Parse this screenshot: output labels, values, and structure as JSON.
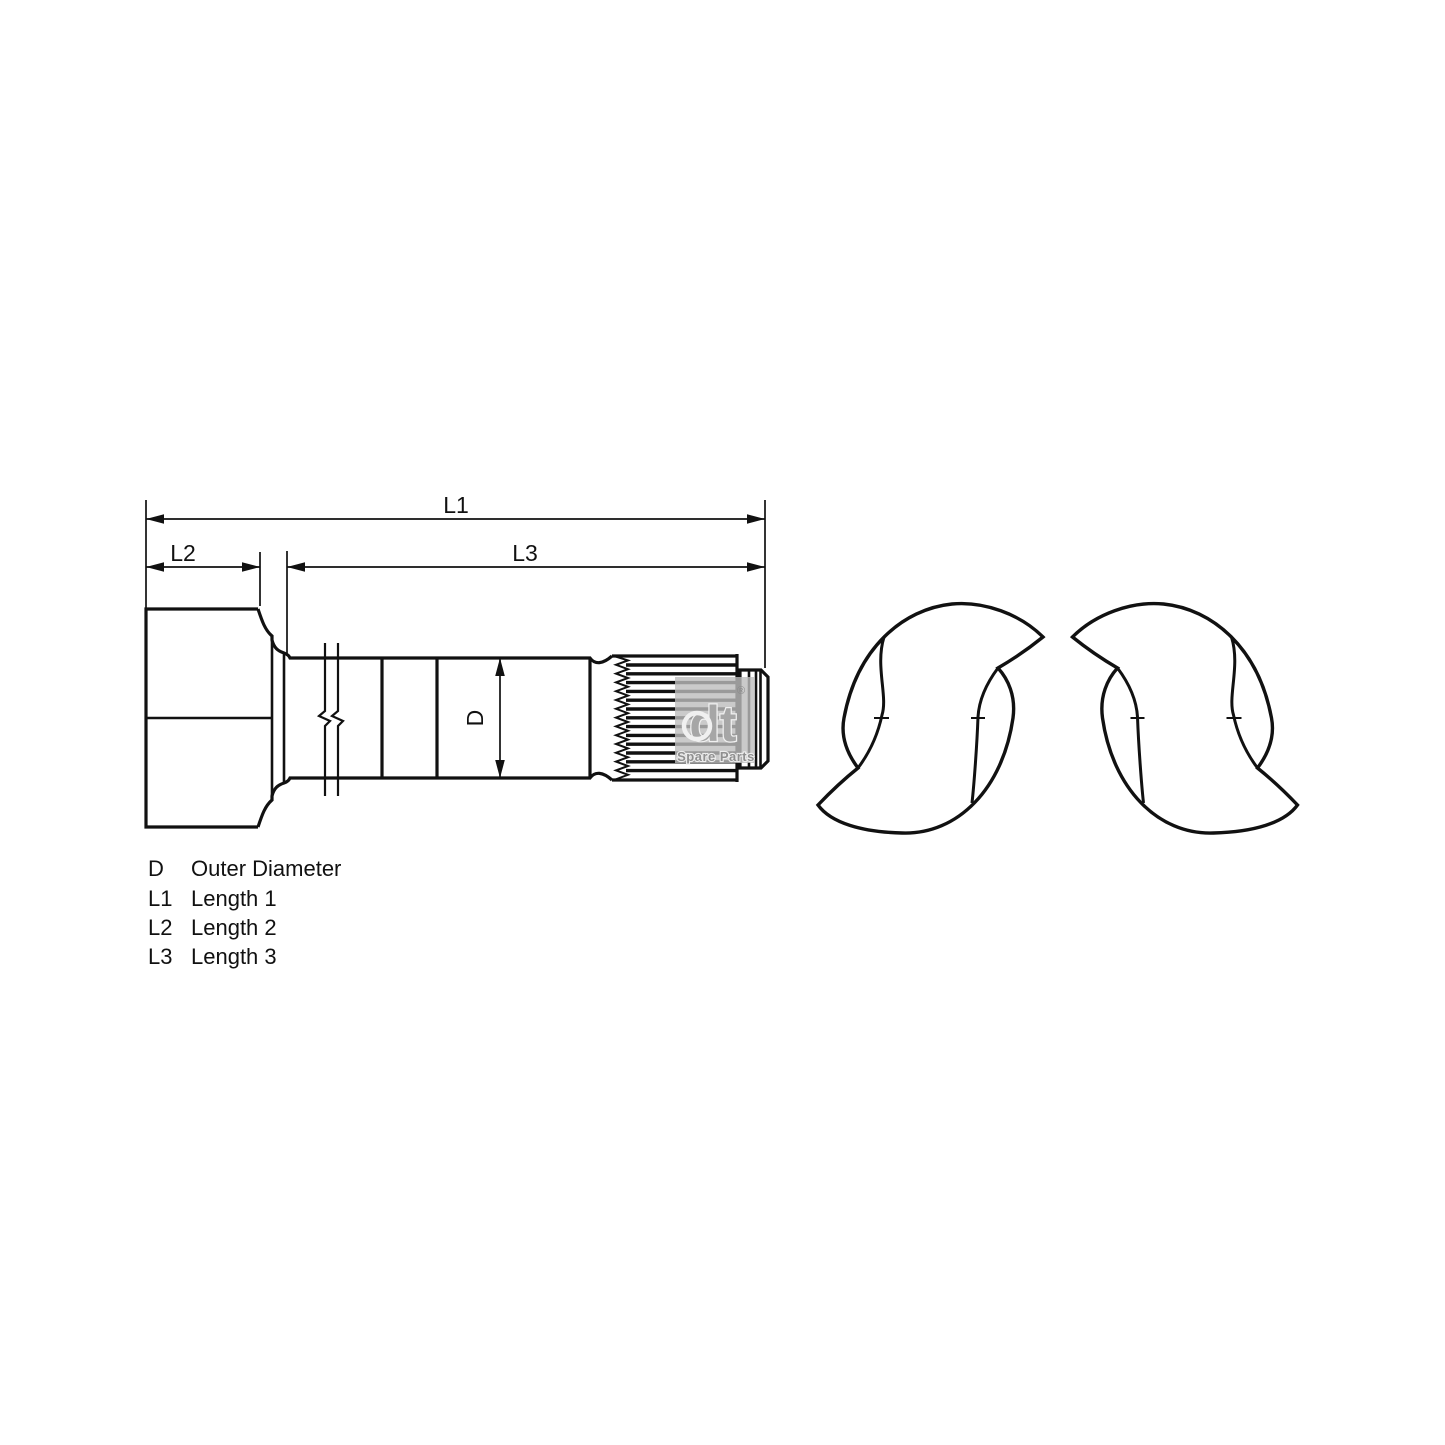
{
  "drawing": {
    "dimension_labels": {
      "l1": "L1",
      "l2": "L2",
      "l3": "L3",
      "d": "D"
    }
  },
  "legend": {
    "rows": [
      {
        "term": "D",
        "desc": "Outer Diameter"
      },
      {
        "term": "L1",
        "desc": "Length 1"
      },
      {
        "term": "L2",
        "desc": "Length 2"
      },
      {
        "term": "L3",
        "desc": "Length 3"
      }
    ]
  },
  "watermark": {
    "logo_text": "dt",
    "registered_mark": "®",
    "subtitle": "Spare Parts"
  },
  "colors": {
    "line": "#111111",
    "background": "#ffffff",
    "watermark_panel": "#bdbdbd",
    "watermark_text": "#9a9a9a"
  }
}
